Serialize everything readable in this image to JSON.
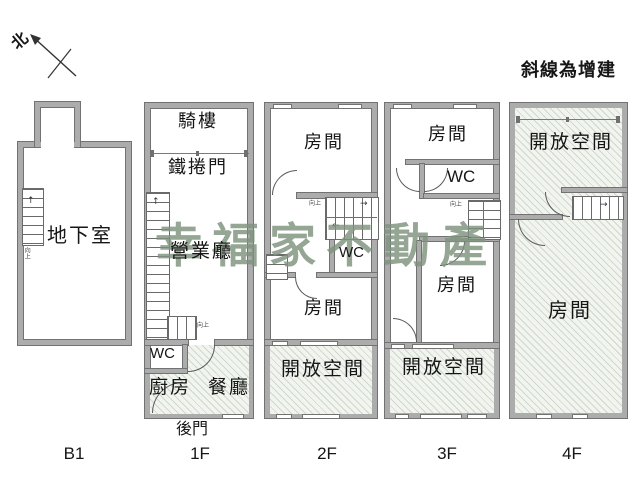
{
  "compass": {
    "north": "北"
  },
  "legend": {
    "note": "斜線為增建"
  },
  "watermark": {
    "text": "幸福家不動產"
  },
  "icons": {
    "up_arrow": "↑",
    "right_arrow": "→",
    "left_arrow": "←"
  },
  "floors": {
    "b1": {
      "label": "B1",
      "basement": "地下室",
      "stair_note": "向上"
    },
    "f1": {
      "label": "1F",
      "arcade": "騎樓",
      "roller_door": "鐵捲門",
      "business_hall": "營業廳",
      "wc": "WC",
      "kitchen": "廚房",
      "dining_room": "餐廳",
      "back_door": "後門",
      "stair_note": "向上"
    },
    "f2": {
      "label": "2F",
      "front_room": "房間",
      "wc": "WC",
      "middle_room": "房間",
      "open_space": "開放空間",
      "stair_note": "向上"
    },
    "f3": {
      "label": "3F",
      "front_room": "房間",
      "wc": "WC",
      "middle_room": "房間",
      "open_space": "開放空間",
      "stair_note": "向上"
    },
    "f4": {
      "label": "4F",
      "open_space": "開放空間",
      "room": "房間"
    }
  },
  "colors": {
    "wall_fill": "#acacac",
    "wall_edge": "#727272",
    "hatch_fill": "#f2f5ef",
    "hatch_line": "#82九b82",
    "watermark_green": "#7e937e"
  }
}
